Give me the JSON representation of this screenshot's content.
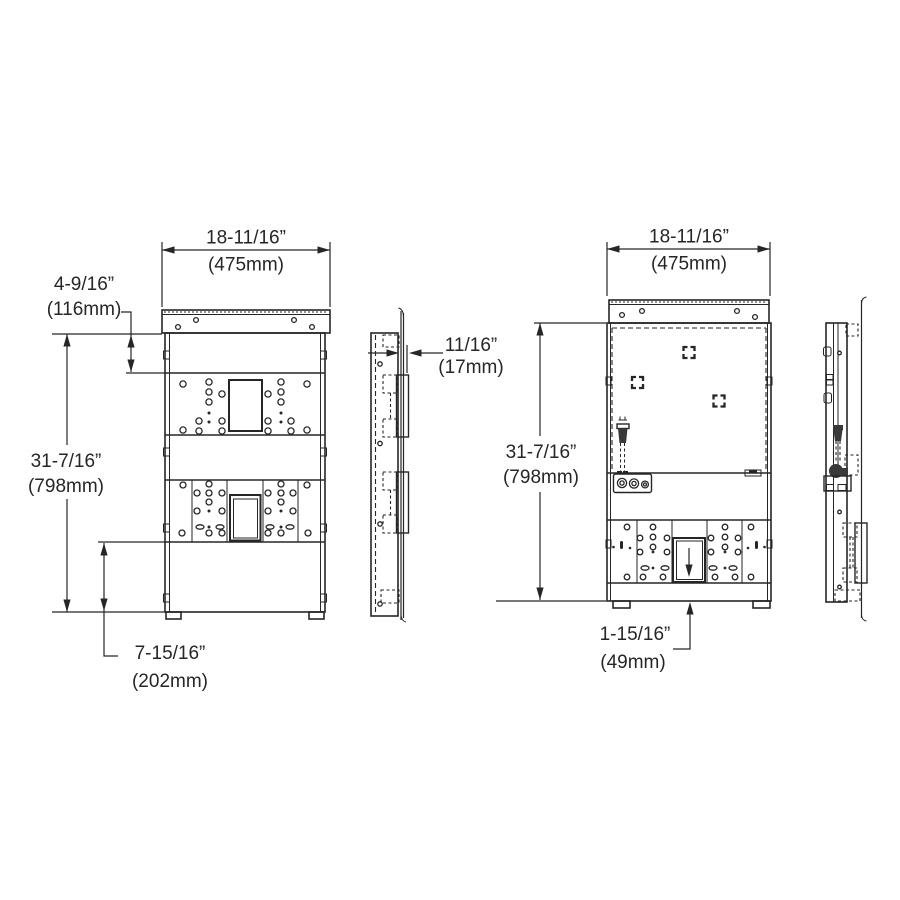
{
  "dims": {
    "front_frame_width_in": "18-11/16”",
    "front_frame_width_mm": "(475mm)",
    "frame_top_offset_in": "4-9/16”",
    "frame_top_offset_mm": "(116mm)",
    "frame_height_in": "31-7/16”",
    "frame_height_mm": "(798mm)",
    "frame_bottom_offset_in": "7-15/16”",
    "frame_bottom_offset_mm": "(202mm)",
    "frame_depth_in": "11/16”",
    "frame_depth_mm": "(17mm)",
    "unit_width_in": "18-11/16”",
    "unit_width_mm": "(475mm)",
    "unit_height_in": "31-7/16”",
    "unit_height_mm": "(798mm)",
    "unit_bottom_offset_in": "1-15/16”",
    "unit_bottom_offset_mm": "(49mm)"
  },
  "colors": {
    "line": "#262626",
    "background": "#ffffff"
  }
}
